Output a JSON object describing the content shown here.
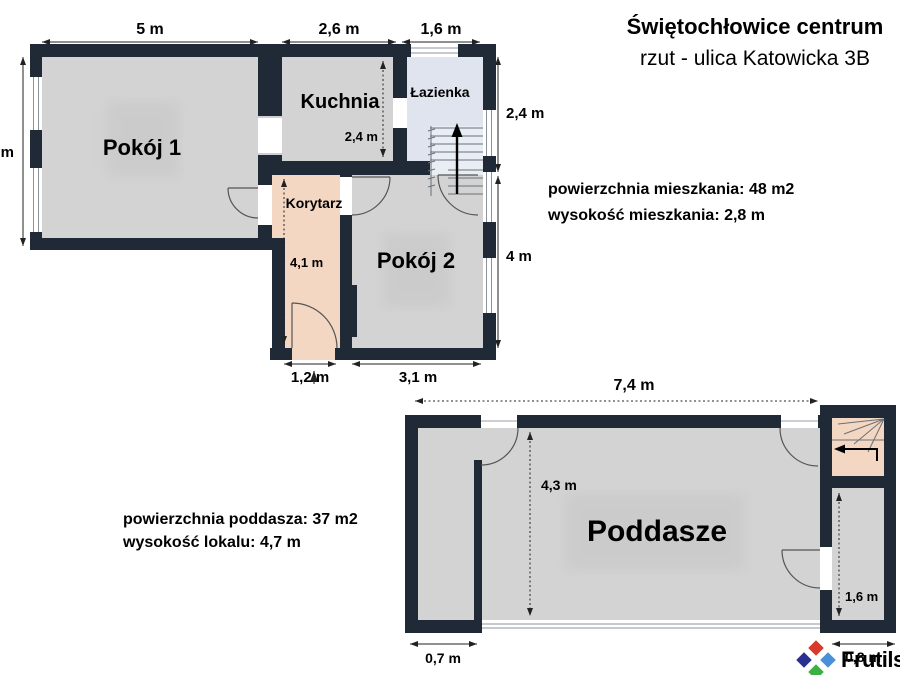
{
  "title": {
    "line1": "Świętochłowice centrum",
    "line2": "rzut - ulica Katowicka 3B"
  },
  "apartment_info": {
    "line1": "powierzchnia mieszkania: 48 m2",
    "line2": "wysokość mieszkania: 2,8 m"
  },
  "attic_info": {
    "line1": "powierzchnia poddasza: 37 m2",
    "line2": "wysokość lokalu: 4,7 m"
  },
  "upper_floor": {
    "rooms": {
      "room1": "Pokój 1",
      "kitchen": "Kuchnia",
      "bathroom": "Łazienka",
      "corridor": "Korytarz",
      "room2": "Pokój 2"
    },
    "dims": {
      "room1_width": "5 m",
      "kitchen_width": "2,6 m",
      "bathroom_width": "1,6 m",
      "left_height": "4 m",
      "bathroom_height": "2,4 m",
      "room2_height": "4 m",
      "corridor_width": "1,2 m",
      "room2_width": "3,1 m",
      "corridor_length": "4,1 m",
      "kitchen_depth": "2,4 m"
    }
  },
  "lower_floor": {
    "rooms": {
      "attic": "Poddasze"
    },
    "dims": {
      "attic_width": "7,4 m",
      "attic_depth": "4,3 m",
      "closet_width": "0,7 m",
      "stair_width": "0,8 m",
      "side_room_height": "1,6 m"
    }
  },
  "logo": {
    "text": "Frutils"
  },
  "colors": {
    "wall": "#202a36",
    "room_fill": "#d3d3d3",
    "bathroom_fill": "#dfe4ee",
    "corridor_fill": "#f3d7c2",
    "shadow_fill": "#c6c6c6",
    "logo_red": "#d8392b",
    "logo_dark_blue": "#2b2f8e",
    "logo_light_blue": "#4a90d8",
    "logo_green": "#3cb043",
    "logo_text": "#1d2230"
  }
}
